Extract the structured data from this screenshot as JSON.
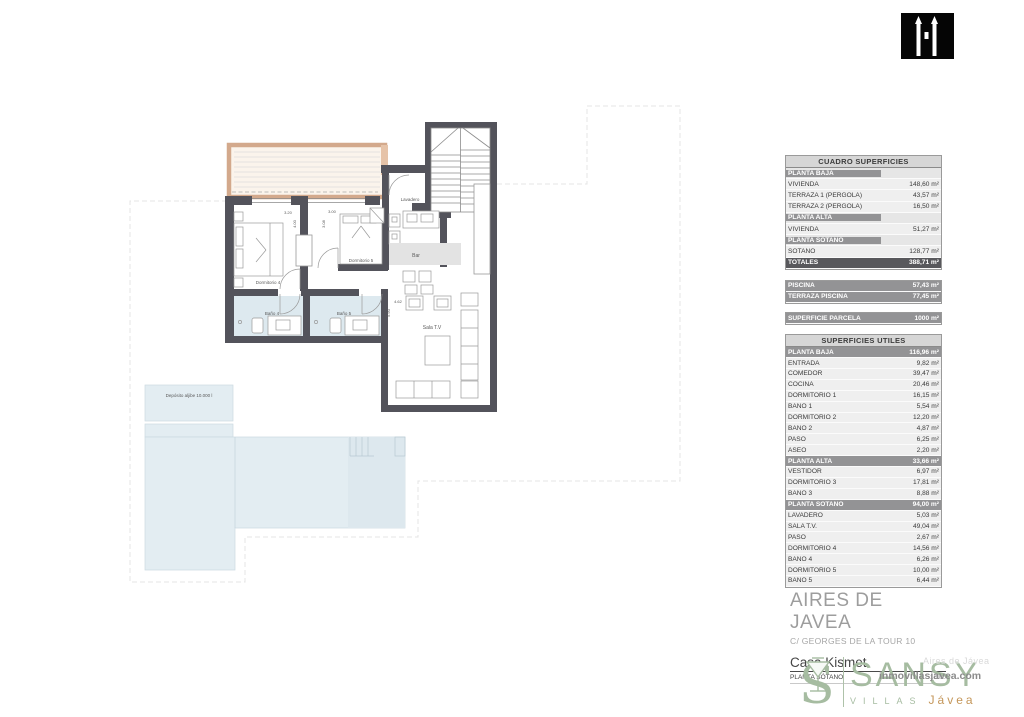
{
  "tables": {
    "cuadro": {
      "title": "CUADRO SUPERFICIES",
      "rows": [
        {
          "type": "section",
          "label": "PLANTA BAJA",
          "value": ""
        },
        {
          "type": "item",
          "label": "VIVIENDA",
          "value": "148,60 m²"
        },
        {
          "type": "item",
          "label": "TERRAZA 1 (PERGOLA)",
          "value": "43,57 m²"
        },
        {
          "type": "item",
          "label": "TERRAZA 2 (PERGOLA)",
          "value": "16,50 m²"
        },
        {
          "type": "section",
          "label": "PLANTA ALTA",
          "value": ""
        },
        {
          "type": "item",
          "label": "VIVIENDA",
          "value": "51,27 m²"
        },
        {
          "type": "section",
          "label": "PLANTA SÓTANO",
          "value": ""
        },
        {
          "type": "item",
          "label": "SOTANO",
          "value": "128,77 m²"
        },
        {
          "type": "total",
          "label": "TOTALES",
          "value": "388,71 m²"
        }
      ]
    },
    "piscina": {
      "rows": [
        {
          "type": "gray",
          "label": "PISCINA",
          "value": "57,43 m²"
        },
        {
          "type": "gray",
          "label": "TERRAZA PISCINA",
          "value": "77,45 m²"
        }
      ]
    },
    "parcela": {
      "rows": [
        {
          "type": "gray",
          "label": "SUPERFICIE PARCELA",
          "value": "1000 m²"
        }
      ]
    },
    "utiles": {
      "title": "SUPERFICIES UTILES",
      "rows": [
        {
          "type": "gray",
          "label": "PLANTA BAJA",
          "value": "116,96 m²"
        },
        {
          "type": "item",
          "label": "ENTRADA",
          "value": "9,82 m²"
        },
        {
          "type": "item",
          "label": "COMEDOR",
          "value": "39,47 m²"
        },
        {
          "type": "item",
          "label": "COCINA",
          "value": "20,46 m²"
        },
        {
          "type": "item",
          "label": "DORMITORIO 1",
          "value": "16,15 m²"
        },
        {
          "type": "item",
          "label": "BAÑO 1",
          "value": "5,54 m²"
        },
        {
          "type": "item",
          "label": "DORMITORIO 2",
          "value": "12,20 m²"
        },
        {
          "type": "item",
          "label": "BAÑO 2",
          "value": "4,87 m²"
        },
        {
          "type": "item",
          "label": "PASO",
          "value": "6,25 m²"
        },
        {
          "type": "item",
          "label": "ASEO",
          "value": "2,20 m²"
        },
        {
          "type": "gray",
          "label": "PLANTA ALTA",
          "value": "33,66 m²"
        },
        {
          "type": "item",
          "label": "VESTIDOR",
          "value": "6,97 m²"
        },
        {
          "type": "item",
          "label": "DORMITORIO 3",
          "value": "17,81 m²"
        },
        {
          "type": "item",
          "label": "BAÑO 3",
          "value": "8,88 m²"
        },
        {
          "type": "gray",
          "label": "PLANTA SOTANO",
          "value": "94,00 m²"
        },
        {
          "type": "item",
          "label": "LAVADERO",
          "value": "5,03 m²"
        },
        {
          "type": "item",
          "label": "SALA T.V.",
          "value": "49,04 m²"
        },
        {
          "type": "item",
          "label": "PASO",
          "value": "2,67 m²"
        },
        {
          "type": "item",
          "label": "DORMITORIO 4",
          "value": "14,56 m²"
        },
        {
          "type": "item",
          "label": "BAÑO 4",
          "value": "6,26 m²"
        },
        {
          "type": "item",
          "label": "DORMITORIO 5",
          "value": "10,00 m²"
        },
        {
          "type": "item",
          "label": "BAÑO 5",
          "value": "6,44 m²"
        }
      ]
    }
  },
  "plan": {
    "labels": {
      "lavadero": "Lavadero",
      "bar": "Bar",
      "dormitorio4": "Dormitorio 4",
      "dormitorio5": "Dormitorio 5",
      "bano4": "Baño 4",
      "bano5": "Baño 5",
      "sala": "Sala T.V",
      "deposito": "Depósito aljibe 10.000 l"
    },
    "dims": {
      "w1": "3.20",
      "h1": "4.00",
      "w2": "3.00",
      "h2": "3.08",
      "w3": "4.62",
      "h3": "5.90"
    }
  },
  "titleblock": {
    "project": "AIRES DE JAVEA",
    "address": "C/ GEORGES DE LA TOUR 10",
    "house": "Casa Kismet",
    "sheet": "PLANTA SÓTANO",
    "scale": "1:100"
  },
  "brand": {
    "name": "SANSY",
    "villas": "VILLAS",
    "javea": "Jávea",
    "watermark_top": "Aires de Jávea",
    "watermark": "inmovillasjavea.com"
  },
  "colors": {
    "wall": "#53535b",
    "pergola": "#d3a98c",
    "water": "#e3edf2",
    "table_gray": "#939395",
    "table_dark": "#58585c",
    "brand_green": "#a6bca1",
    "brand_gold": "#c49659"
  }
}
